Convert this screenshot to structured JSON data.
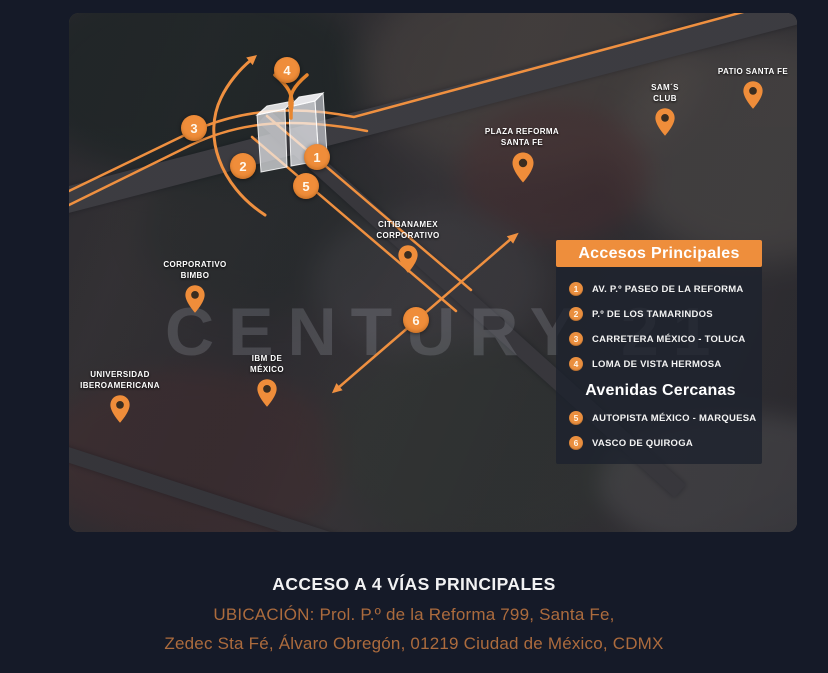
{
  "colors": {
    "background_navy": "#151a28",
    "accent_orange": "#ee8e3c",
    "address_text": "#ac6b3d",
    "panel_dark": "#1c212d"
  },
  "map": {
    "watermark": "CENTURY 21",
    "pois": [
      {
        "name": "patio-santa-fe",
        "line1": "PATIO SANTA FE",
        "line2": ""
      },
      {
        "name": "sams-club",
        "line1": "SAM´S",
        "line2": "CLUB"
      },
      {
        "name": "plaza-reforma-santa-fe",
        "line1": "PLAZA REFORMA",
        "line2": "SANTA FE"
      },
      {
        "name": "citibanamex-corporativo",
        "line1": "CITIBANAMEX",
        "line2": "CORPORATIVO"
      },
      {
        "name": "corporativo-bimbo",
        "line1": "CORPORATIVO",
        "line2": "BIMBO"
      },
      {
        "name": "ibm-de-mexico",
        "line1": "IBM DE",
        "line2": "MÉXICO"
      },
      {
        "name": "universidad-iberoamericana",
        "line1": "UNIVERSIDAD",
        "line2": "IBEROAMERICANA"
      }
    ],
    "markers": [
      {
        "num": "1"
      },
      {
        "num": "2"
      },
      {
        "num": "3"
      },
      {
        "num": "4"
      },
      {
        "num": "5"
      },
      {
        "num": "6"
      }
    ]
  },
  "legend": {
    "title": "Accesos Principales",
    "items_main": [
      {
        "num": "1",
        "label": "AV. P.º PASEO DE LA REFORMA"
      },
      {
        "num": "2",
        "label": "P.º DE LOS TAMARINDOS"
      },
      {
        "num": "3",
        "label": "CARRETERA MÉXICO - TOLUCA"
      },
      {
        "num": "4",
        "label": "LOMA DE VISTA HERMOSA"
      }
    ],
    "subtitle": "Avenidas Cercanas",
    "items_nearby": [
      {
        "num": "5",
        "label": "AUTOPISTA MÉXICO - MARQUESA"
      },
      {
        "num": "6",
        "label": "VASCO DE QUIROGA"
      }
    ]
  },
  "footer": {
    "title": "ACCESO A 4 VÍAS PRINCIPALES",
    "address_line1": "UBICACIÓN: Prol. P.º de la Reforma 799, Santa Fe,",
    "address_line2": "Zedec Sta Fé, Álvaro Obregón, 01219 Ciudad de México, CDMX"
  }
}
